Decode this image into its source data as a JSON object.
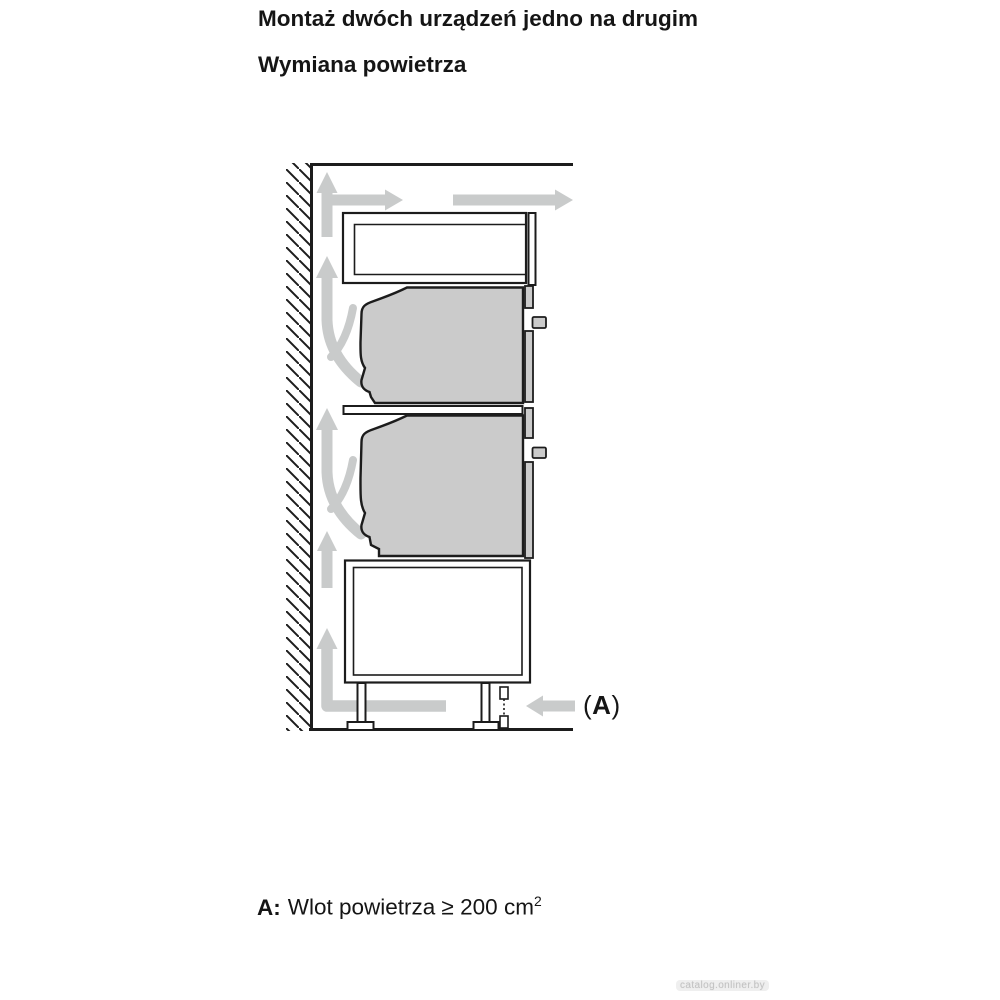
{
  "page": {
    "heading_primary": "Montaż dwóch urządzeń jedno na drugim",
    "heading_secondary": "Wymiana powietrza",
    "footnote": {
      "label": "A:",
      "text": "Wlot powietrza ≥ 200 cm",
      "superscript": "2"
    },
    "watermark": "catalog.onliner.by"
  },
  "diagram": {
    "callout_a": {
      "open": "(",
      "letter": "A",
      "close": ")"
    },
    "colors": {
      "outline": "#1c1c1c",
      "appliance_fill": "#cbcbcb",
      "airflow_arrow": "#c9cbcb",
      "background": "#ffffff"
    },
    "airflow_arrows": [
      {
        "name": "wall-gap-top-up",
        "direction": "up"
      },
      {
        "name": "top-outlet-short",
        "direction": "right"
      },
      {
        "name": "top-outlet-long",
        "direction": "right"
      },
      {
        "name": "behind-upper-oven-curved",
        "direction": "up"
      },
      {
        "name": "behind-lower-oven-curved",
        "direction": "up"
      },
      {
        "name": "wall-gap-middle-up",
        "direction": "up"
      },
      {
        "name": "floor-to-wall-gap",
        "direction": "up"
      },
      {
        "name": "air-inlet-a",
        "direction": "left"
      }
    ]
  }
}
